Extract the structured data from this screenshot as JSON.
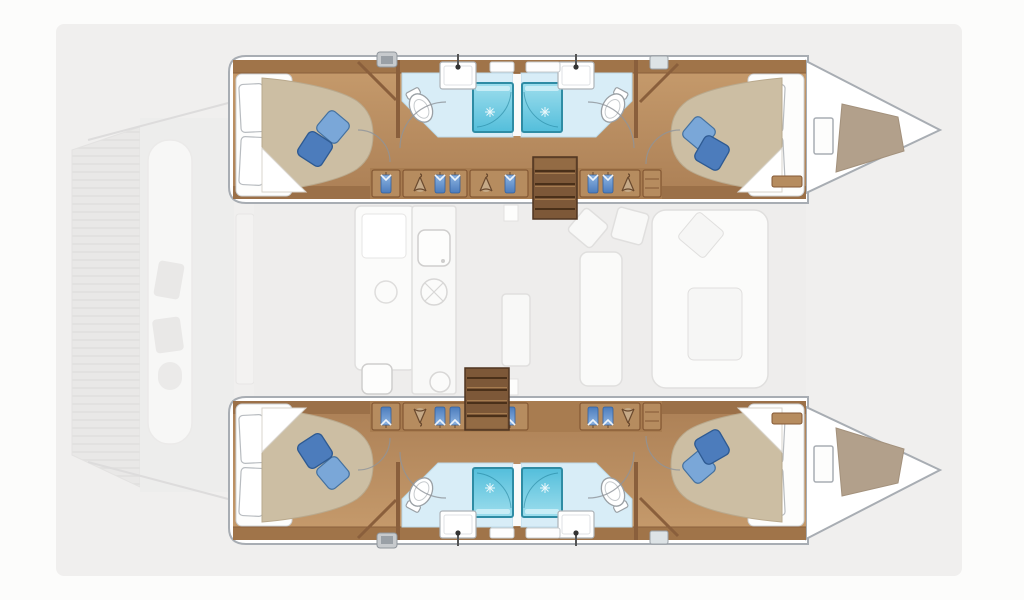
{
  "diagram": {
    "type": "floorplan",
    "subject": "catamaran-yacht-interior-deck-plan",
    "orientation": "bow-right",
    "counts": {
      "hulls": 2,
      "double_cabins": 4,
      "bathrooms": 4,
      "showers": 4,
      "toilets": 4,
      "sinks": 4,
      "companionway_stairs": 2,
      "blue_cushions_per_bed": 2,
      "wardrobe_sections_per_hull": 4
    },
    "legend": {
      "hulls": [
        "port-hull-top",
        "starboard-hull-bottom"
      ],
      "rooms_per_hull": [
        "aft-double-cabin",
        "aft-bathroom",
        "wardrobe-corridor",
        "companionway-stairs",
        "forward-double-cabin",
        "forward-bathroom",
        "bow-storage-locker"
      ],
      "saloon_ghost_items": [
        "galley-counter",
        "galley-sink",
        "stove",
        "dining-seating",
        "saloon-table",
        "lounge-sofa"
      ],
      "deck_ghost_items": [
        "aft-deck-planking",
        "transom-platform",
        "cockpit-door"
      ]
    },
    "colors": {
      "background": "#fcfcfb",
      "plan_background": "#f0efee",
      "ghost_deck": "#e9e8e7",
      "ghost_white": "#f7f7f6",
      "hull_fill": "#ffffff",
      "hull_outline": "#a8adb3",
      "wood_light": "#c79c6d",
      "wood_dark": "#ab7f55",
      "wood_trim": "#a07449",
      "wood_wall": "#8a5f3c",
      "closet_panel": "#b68c5f",
      "stairs_wood": "#7d5838",
      "stairs_line": "#4a3019",
      "mattress": "#ccbea3",
      "pillow_white": "#ffffff",
      "cushion_blue_light": "#7aa7d8",
      "cushion_blue_dark": "#4c7cbc",
      "bath_floor": "#d8edf7",
      "shower_top": "#9edeed",
      "shower_bottom": "#53bedb",
      "shower_border": "#2e8ca4",
      "bow_locker_tan": "#b2a08b"
    }
  }
}
